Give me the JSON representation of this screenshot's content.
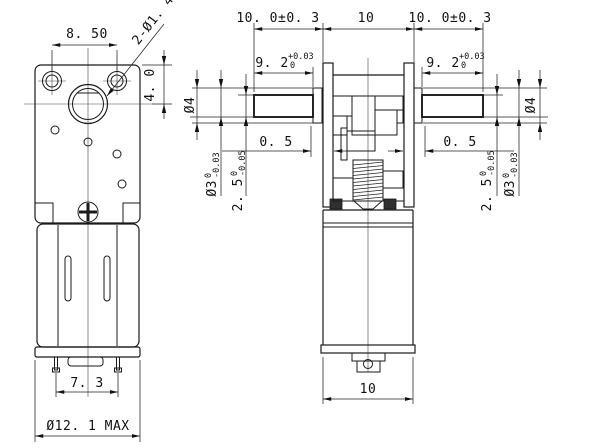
{
  "drawing": {
    "type": "technical-dimension-drawing",
    "subject": "worm gear motor, front and side views",
    "front_view": {
      "hole_spacing": "8. 50",
      "holes_note": "2-Ø1. 4",
      "boss_offset": "4. 0",
      "pin_pitch": "7. 3",
      "max_dia": "Ø12. 1 MAX"
    },
    "side_view": {
      "shaft_left_len": "10. 0±0. 3",
      "case_width_top": "10",
      "shaft_right_len": "10. 0±0. 3",
      "flat_len": "9. 2",
      "flat_len_tol_upper": "+0.03",
      "flat_len_tol_lower": "0",
      "hub_gap": "0. 5",
      "shaft_dia": "Ø4",
      "bearing_dia": "Ø3",
      "bearing_tol_upper": "0",
      "bearing_tol_lower": "-0.03",
      "flat_height": "2. 5",
      "flat_height_tol_upper": "0",
      "flat_height_tol_lower": "-0.05",
      "motor_width_bottom": "10"
    },
    "line_color": "#1a1a1a",
    "background": "#ffffff"
  }
}
